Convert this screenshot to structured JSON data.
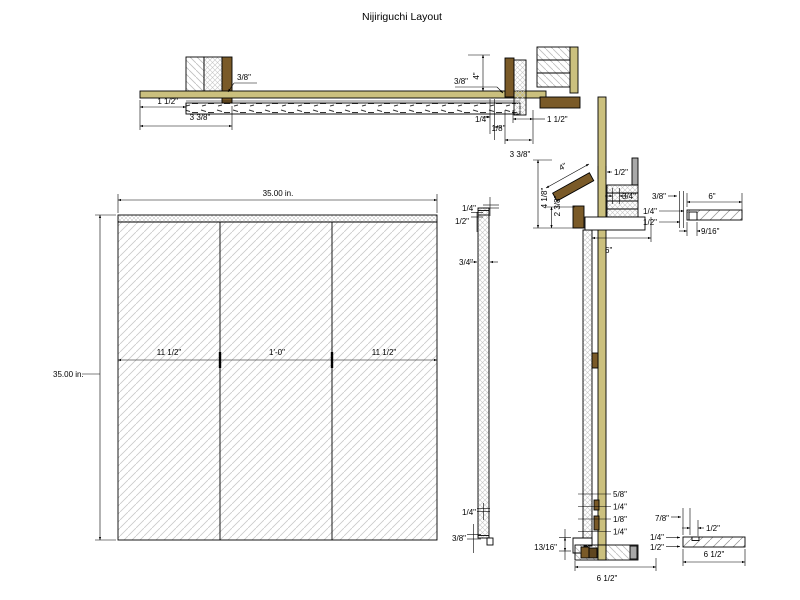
{
  "title": "Nijiriguchi Layout",
  "colors": {
    "wood_tan": "#cbc07e",
    "wood_brown": "#7a5a28",
    "wood_brown_dark": "#5f461f",
    "metal_gray": "#a8a8a8",
    "hatch_gray": "#c9c9c9",
    "line": "#000000",
    "background": "#ffffff"
  },
  "head_section": {
    "jamb_gap": "3/8\"",
    "left_offset": "1 1/2\"",
    "left_depth": "3 3/8\"",
    "right_gap": "3/8\"",
    "right_height": "4\"",
    "panel_gap": "1/4\"",
    "reveal": "1/8\"",
    "right_offset": "1 1/2\"",
    "right_depth": "3 3/8\""
  },
  "panel": {
    "width": "35.00 in.",
    "height": "35.00 in.",
    "left_stile": "11 1/2\"",
    "center_panel": "1'-0\"",
    "right_stile": "11 1/2\""
  },
  "edge": {
    "top_a": "1/4\"",
    "top_b": "1/2\"",
    "thickness": "3/4\"",
    "bottom_a": "1/4\"",
    "bottom_b": "3/8\""
  },
  "jamb": {
    "lintel_width": "4\"",
    "gap_half": "1/2\"",
    "stop": "3/4\"",
    "lintel_height": "4 1/8\"",
    "lintel_inner": "2 3/8\"",
    "depth": "6\"",
    "stack_a": "5/8\"",
    "stack_b": "1/4\"",
    "stack_c": "1/8\"",
    "stack_d": "1/4\"",
    "sill_height": "13/16\"",
    "sill_width": "6 1/2\""
  },
  "detail_top": {
    "a": "3/8\"",
    "b": "6\"",
    "c": "1/4\"",
    "d": "1/2\"",
    "e": "9/16\""
  },
  "detail_bottom": {
    "a": "7/8\"",
    "b": "1/2\"",
    "c": "1/4\"",
    "d": "1/2\"",
    "e": "6 1/2\""
  }
}
